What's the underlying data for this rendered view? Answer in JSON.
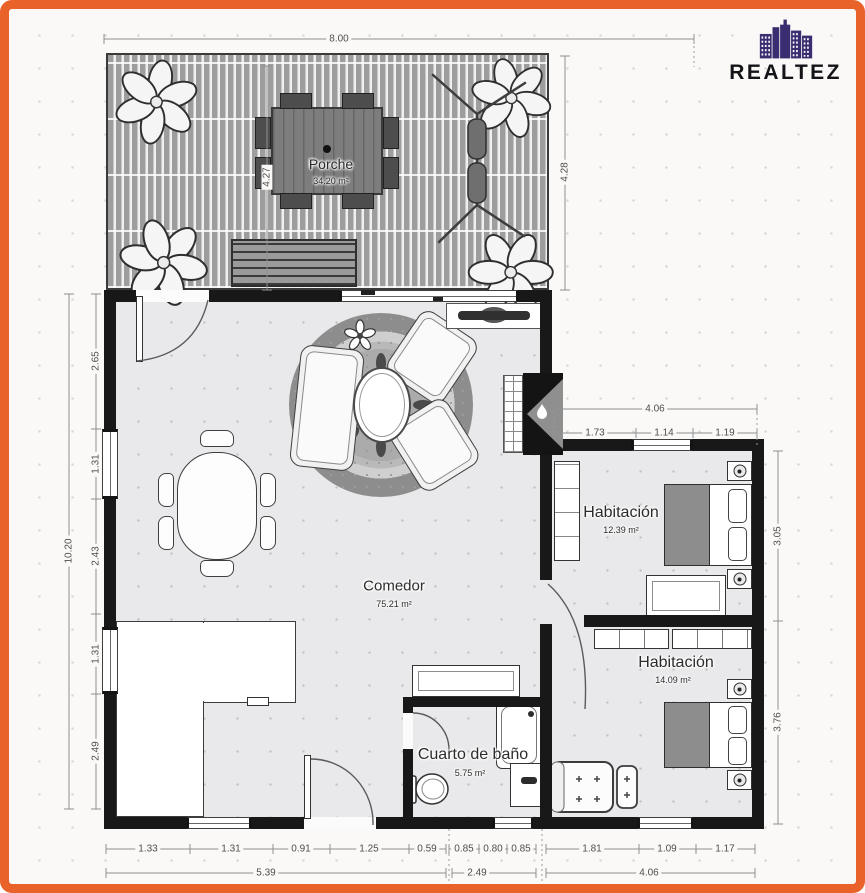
{
  "brand": {
    "name": "REALTEZ"
  },
  "colors": {
    "accent_orange": "#e8622a",
    "logo_purple": "#3a2e71",
    "wall_black": "#181818",
    "floor_gray": "#e9e9eb",
    "deck_gray": "#9d9d9d"
  },
  "icons": {
    "brand_logo": "city-skyline-icon",
    "fireplace": "flame-icon",
    "plant": "potted-plant-icon",
    "porch_rack": "drying-rack-icon"
  },
  "rooms": {
    "porche": {
      "name": "Porche",
      "area": "34.20 m²"
    },
    "comedor": {
      "name": "Comedor",
      "area": "75.21 m²"
    },
    "habitacion_1": {
      "name": "Habitación",
      "area": "12.39 m²"
    },
    "habitacion_2": {
      "name": "Habitación",
      "area": "14.09 m²"
    },
    "bano": {
      "name": "Cuarto de baño",
      "area": "5.75 m²"
    }
  },
  "dims": {
    "top_width": "8.00",
    "porch_left": "4.27",
    "porch_right": "4.28",
    "left_total": "10.20",
    "left_segments": [
      "2.65",
      "1.31",
      "2.43",
      "1.31",
      "2.49"
    ],
    "bed1_width": "4.06",
    "bed1_segments": [
      "1.73",
      "1.14",
      "1.19"
    ],
    "bed1_height": "3.05",
    "bed2_height": "3.76",
    "bottom_segments": [
      "1.33",
      "1.31",
      "0.91",
      "1.25",
      "0.59",
      "0.85",
      "0.80",
      "0.85",
      "1.81",
      "1.09",
      "1.17"
    ],
    "bottom_totals": [
      "5.39",
      "2.49",
      "4.06"
    ]
  }
}
